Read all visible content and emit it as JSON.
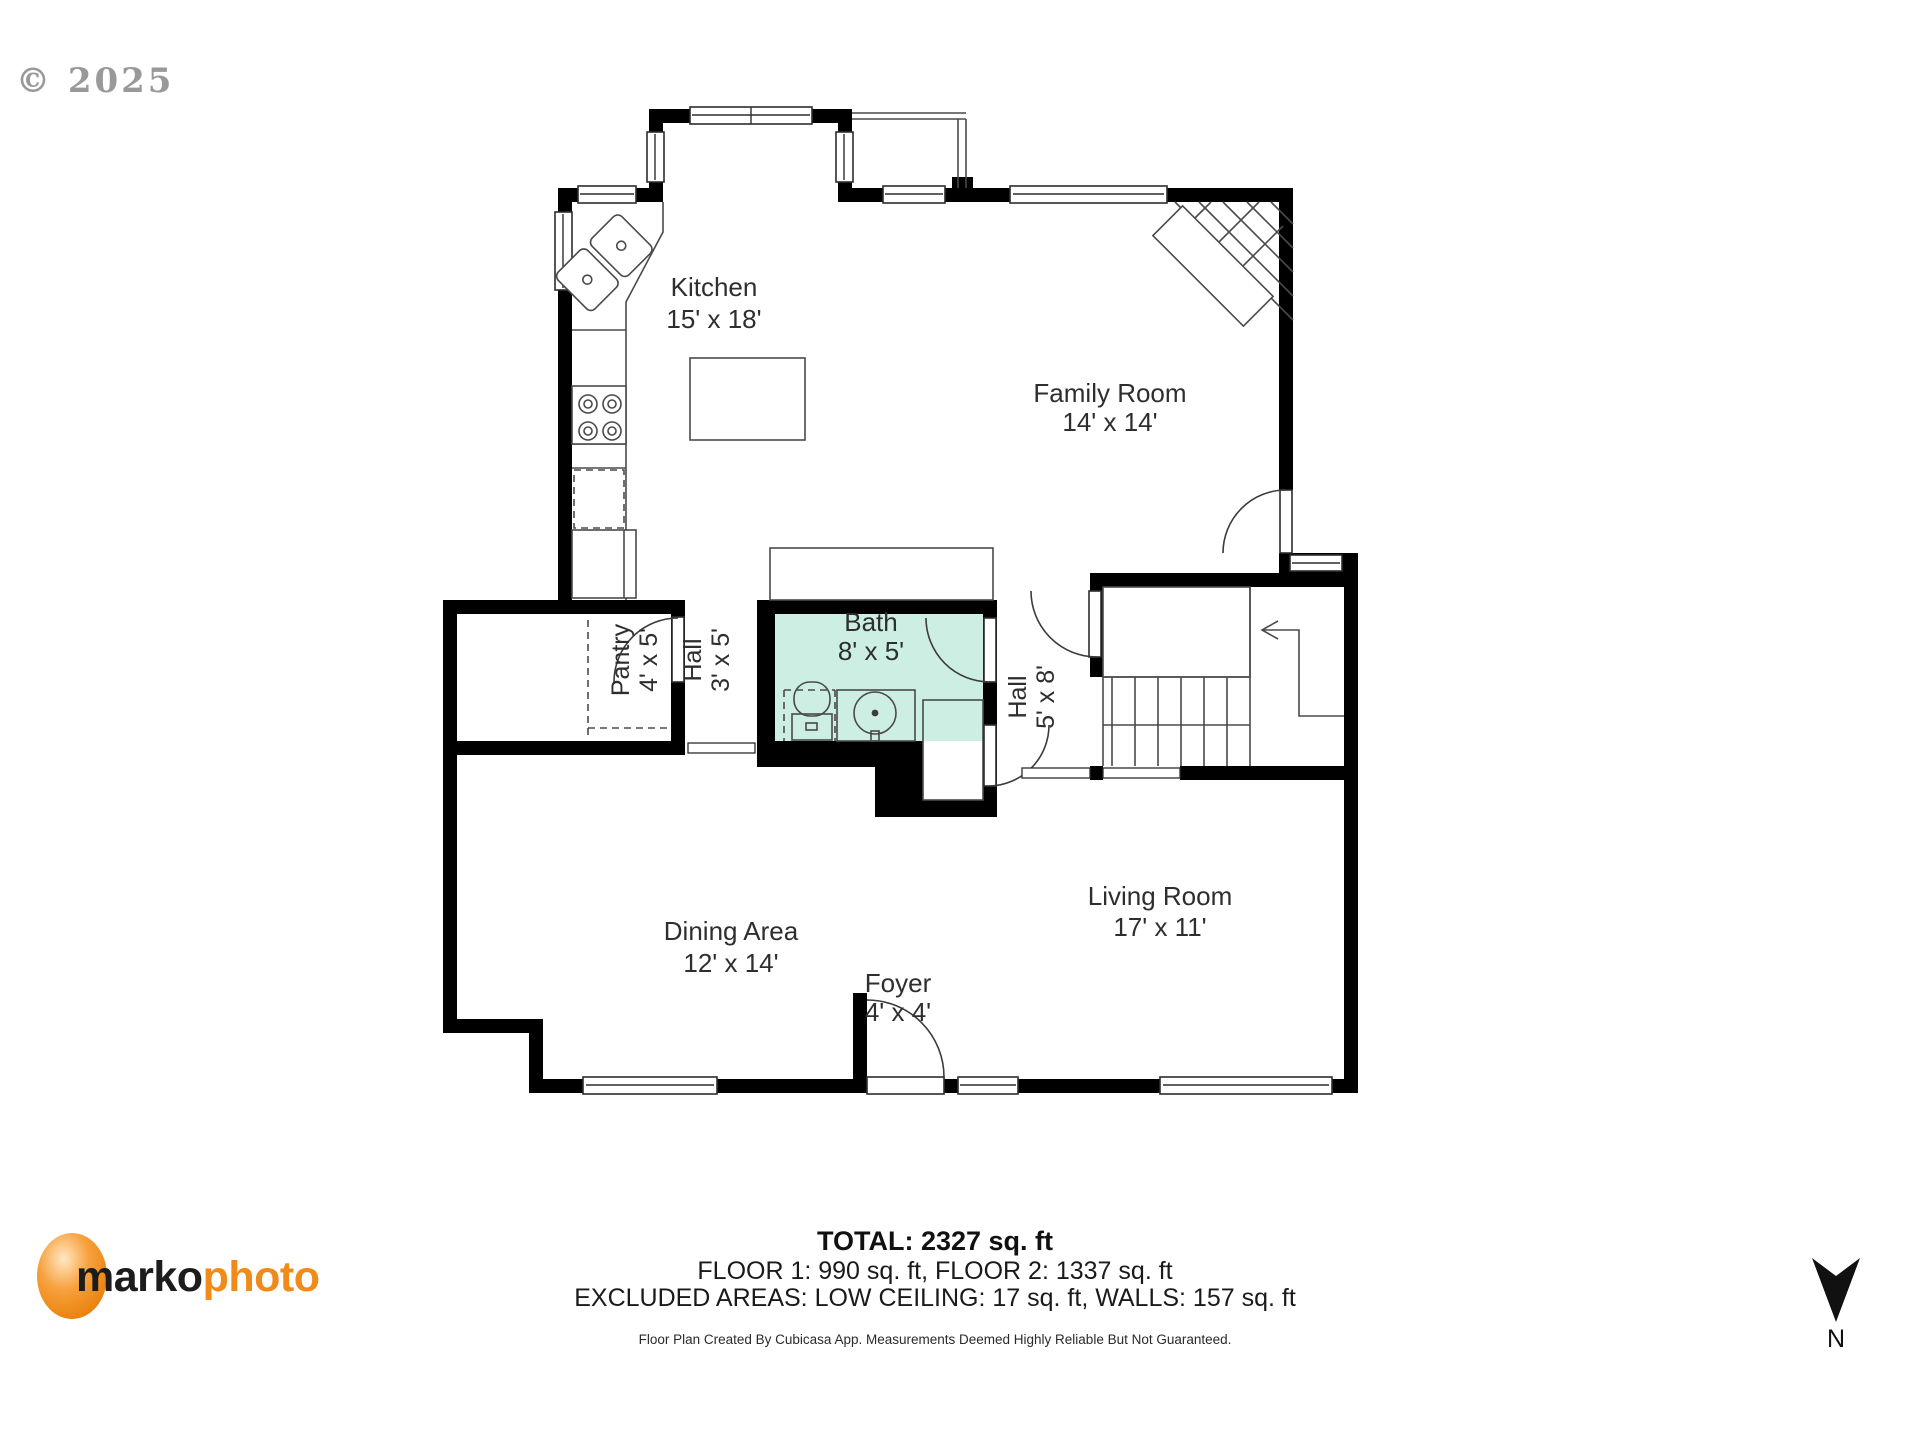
{
  "watermark": {
    "text": "© 2025",
    "color": "#8f8f8f"
  },
  "floorplan": {
    "type": "residential-floor-plan",
    "rooms": [
      {
        "id": "kitchen",
        "name": "Kitchen",
        "dims": "15' x 18'"
      },
      {
        "id": "family-room",
        "name": "Family Room",
        "dims": "14' x 14'"
      },
      {
        "id": "pantry",
        "name": "Pantry",
        "dims": "4' x 5'"
      },
      {
        "id": "hall-small",
        "name": "Hall",
        "dims": "3' x 5'"
      },
      {
        "id": "bath",
        "name": "Bath",
        "dims": "8' x 5'"
      },
      {
        "id": "hall-large",
        "name": "Hall",
        "dims": "5' x 8'"
      },
      {
        "id": "dining-area",
        "name": "Dining Area",
        "dims": "12' x 14'"
      },
      {
        "id": "living-room",
        "name": "Living Room",
        "dims": "17' x 11'"
      },
      {
        "id": "foyer",
        "name": "Foyer",
        "dims": "4' x 4'"
      }
    ],
    "colors": {
      "wall": "#000000",
      "bathfloor": "#cdeee3",
      "line": "#4a4a4a",
      "label": "#2e2e2e",
      "wmcolor": "#8f8f8f"
    },
    "fixtures": [
      "corner-sink",
      "stove-4-burner",
      "dishwasher",
      "refrigerator",
      "kitchen-island",
      "fireplace",
      "toilet",
      "vanity-sink",
      "staircase-up",
      "closets"
    ]
  },
  "footer": {
    "total": "TOTAL: 2327 sq. ft",
    "floors": "FLOOR 1: 990 sq. ft, FLOOR 2: 1337 sq. ft",
    "excluded": "EXCLUDED AREAS: LOW CEILING: 17 sq. ft, WALLS: 157 sq. ft",
    "disclaimer": "Floor Plan Created By Cubicasa App. Measurements Deemed Highly Reliable But Not Guaranteed."
  },
  "logo": {
    "part1": "marko",
    "part2": "photo",
    "part1_color": "#1c1c1c",
    "part2_color": "#f08a18",
    "circle_color": "#ed7d02"
  },
  "compass": {
    "label": "N",
    "icon": "north-arrow"
  }
}
